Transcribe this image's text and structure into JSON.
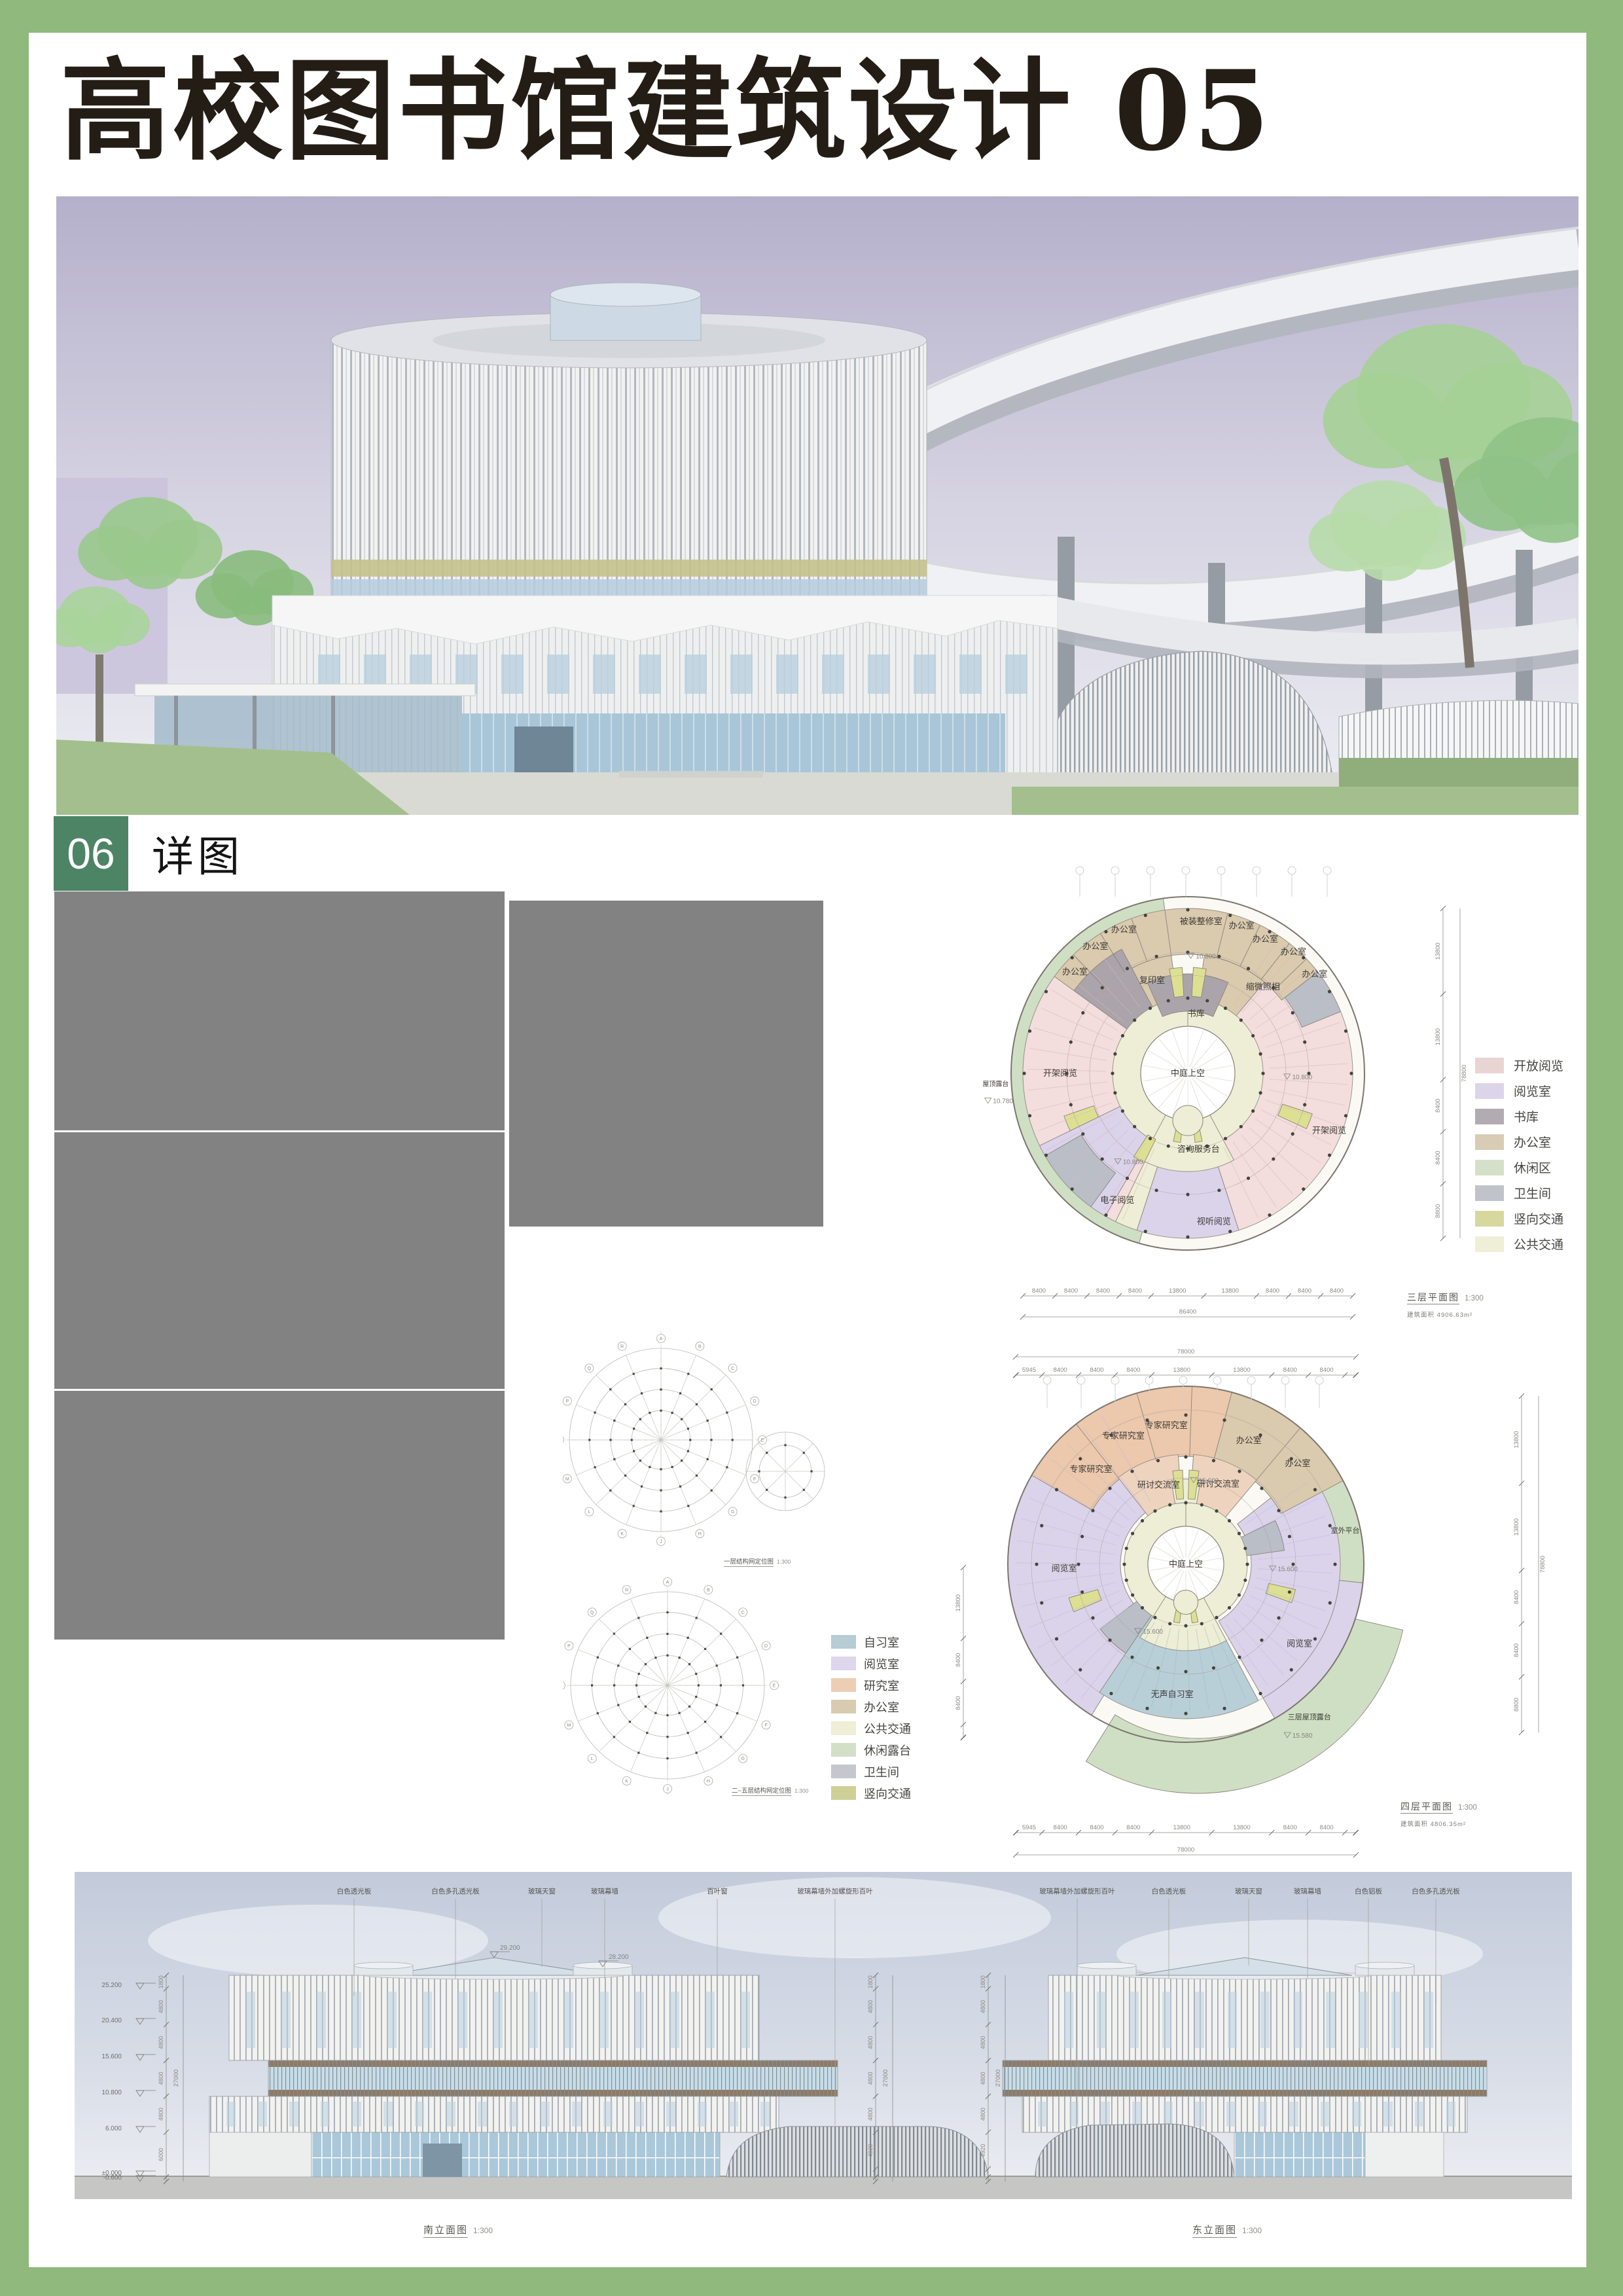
{
  "page": {
    "background_color": "#8fb97d",
    "title": "高校图书馆建筑设计 05",
    "section_number": "06",
    "section_title": "详图"
  },
  "palette": {
    "open": "#f3dddd",
    "reading": "#dbd3ea",
    "book": "#aba4aa",
    "office": "#dacaae",
    "terrace": "#cfdfc3",
    "wc": "#b9bec7",
    "stair": "#dde092",
    "core": "#edeed5",
    "study": "#b8cfd8",
    "expert": "#ecc8ac",
    "seminar": "#eed3bf",
    "atrium": "#ffffff",
    "accent_green": "#4d8465",
    "frame_green": "#8fb97d",
    "placeholder_gray": "#828282"
  },
  "legend_plan3": {
    "items": [
      {
        "label": "开放阅览",
        "color": "#e9d4d4"
      },
      {
        "label": "阅览室",
        "color": "#dcd5ea"
      },
      {
        "label": "书库",
        "color": "#b2acb2"
      },
      {
        "label": "办公室",
        "color": "#d8ccb4"
      },
      {
        "label": "休闲区",
        "color": "#d5e0c8"
      },
      {
        "label": "卫生间",
        "color": "#c0c3ca"
      },
      {
        "label": "竖向交通",
        "color": "#d6d89e"
      },
      {
        "label": "公共交通",
        "color": "#efeed7"
      }
    ]
  },
  "legend_plan4": {
    "items": [
      {
        "label": "自习室",
        "color": "#b7ccd5"
      },
      {
        "label": "阅览室",
        "color": "#ddd6ec"
      },
      {
        "label": "研究室",
        "color": "#edcdb4"
      },
      {
        "label": "办公室",
        "color": "#d8cbb1"
      },
      {
        "label": "公共交通",
        "color": "#efeed6"
      },
      {
        "label": "休闲露台",
        "color": "#d2e0c8"
      },
      {
        "label": "卫生间",
        "color": "#c4c7ce"
      },
      {
        "label": "竖向交通",
        "color": "#cfd096"
      }
    ]
  },
  "plan3": {
    "caption": "三层平面图",
    "scale": "1:300",
    "area_label": "建筑面积",
    "area_value": "4906.63m²",
    "sectors": [
      [
        197,
        332,
        108,
        252,
        "open"
      ],
      [
        28,
        162,
        108,
        252,
        "open"
      ],
      [
        306,
        52,
        182,
        252,
        "office"
      ],
      [
        210,
        244,
        112,
        252,
        "reading"
      ],
      [
        162,
        198,
        112,
        252,
        "reading"
      ],
      [
        198,
        206,
        112,
        252,
        "core"
      ],
      [
        0,
        360,
        72,
        115,
        "core"
      ],
      [
        352,
        8,
        115,
        148,
        "core"
      ],
      [
        152,
        208,
        72,
        150,
        "core"
      ],
      [
        306,
        332,
        115,
        215,
        "book"
      ],
      [
        332,
        352,
        115,
        182,
        "office"
      ],
      [
        8,
        40,
        115,
        182,
        "office"
      ],
      [
        336,
        24,
        95,
        152,
        "book"
      ],
      [
        216,
        240,
        188,
        252,
        "wc"
      ],
      [
        52,
        68,
        188,
        252,
        "wc"
      ],
      [
        350,
        357,
        118,
        162,
        "stair"
      ],
      [
        3,
        10,
        118,
        162,
        "stair"
      ],
      [
        244,
        251,
        152,
        200,
        "stair"
      ],
      [
        108,
        115,
        152,
        200,
        "stair"
      ],
      [
        168,
        174,
        76,
        106,
        "stair"
      ],
      [
        186,
        192,
        76,
        106,
        "stair"
      ],
      [
        206,
        213,
        112,
        152,
        "stair"
      ],
      [
        196,
        352,
        252,
        270,
        "terrace"
      ]
    ],
    "dividers": [
      [
        316,
        182,
        252
      ],
      [
        328,
        182,
        252
      ],
      [
        340,
        182,
        252
      ],
      [
        352,
        182,
        252
      ],
      [
        14,
        182,
        252
      ],
      [
        26,
        182,
        252
      ],
      [
        38,
        182,
        252
      ],
      [
        46,
        182,
        252
      ]
    ],
    "labels": [
      {
        "t": "办公室",
        "a": 312,
        "r": 232
      },
      {
        "t": "办公室",
        "a": 324,
        "r": 240
      },
      {
        "t": "办公室",
        "a": 336,
        "r": 240
      },
      {
        "t": "被装整修室",
        "a": 5,
        "r": 233
      },
      {
        "t": "办公室",
        "a": 20,
        "r": 240
      },
      {
        "t": "办公室",
        "a": 30,
        "r": 237
      },
      {
        "t": "办公室",
        "a": 41,
        "r": 246
      },
      {
        "t": "办公室",
        "a": 52,
        "r": 246
      },
      {
        "t": "复印室",
        "a": 339,
        "r": 152
      },
      {
        "t": "缩微照相",
        "a": 41,
        "r": 175
      },
      {
        "t": "书库",
        "a": 8,
        "r": 92
      },
      {
        "t": "中庭上空",
        "a": 0,
        "r": 0
      },
      {
        "t": "咨询服务台",
        "a": 172,
        "r": 117
      },
      {
        "t": "电子阅览",
        "a": 209,
        "r": 222
      },
      {
        "t": "视听阅览",
        "a": 170,
        "r": 230
      },
      {
        "t": "开架阅览",
        "a": 270,
        "r": 195
      },
      {
        "t": "开架阅览",
        "a": 112,
        "r": 233
      },
      {
        "t": "屋顶露台",
        "a": 267,
        "r": 294,
        "fs": 10
      },
      {
        "t": "10.800",
        "a": 7,
        "r": 177,
        "lvl": 1
      },
      {
        "t": "10.800",
        "a": 93,
        "r": 169,
        "lvl": 1
      },
      {
        "t": "10.800",
        "a": 213,
        "r": 165,
        "lvl": 1
      },
      {
        "t": "10.780",
        "a": 261,
        "r": 292,
        "lvl": 1
      }
    ],
    "dims_bottom": {
      "segments": [
        "8400",
        "8400",
        "8400",
        "8400",
        "13800",
        "13800",
        "8400",
        "8400",
        "8400"
      ],
      "total": "86400"
    },
    "dims_right": {
      "segments": [
        "13800",
        "13800",
        "8400",
        "8400",
        "8800"
      ],
      "total": "78800"
    }
  },
  "plan4": {
    "caption": "四层平面图",
    "scale": "1:300",
    "area_label": "建筑面积",
    "area_value": "4806.35m²",
    "sectors": [
      [
        103,
        212,
        238,
        322,
        "terrace",
        "o"
      ],
      [
        58,
        96,
        224,
        272,
        "terrace"
      ],
      [
        212,
        338,
        100,
        272,
        "reading"
      ],
      [
        52,
        150,
        100,
        236,
        "reading"
      ],
      [
        96,
        150,
        236,
        272,
        "reading"
      ],
      [
        300,
        15,
        165,
        272,
        "expert"
      ],
      [
        15,
        62,
        165,
        272,
        "office"
      ],
      [
        322,
        356,
        92,
        168,
        "seminar"
      ],
      [
        4,
        40,
        92,
        168,
        "seminar"
      ],
      [
        152,
        214,
        94,
        236,
        "study"
      ],
      [
        0,
        360,
        58,
        94,
        "core"
      ],
      [
        350,
        10,
        94,
        130,
        "core"
      ],
      [
        152,
        212,
        58,
        132,
        "core"
      ],
      [
        214,
        233,
        94,
        164,
        "wc"
      ],
      [
        64,
        82,
        94,
        152,
        "wc"
      ],
      [
        352,
        358,
        100,
        144,
        "stair"
      ],
      [
        2,
        8,
        100,
        144,
        "stair"
      ],
      [
        247,
        254,
        140,
        186,
        "stair"
      ],
      [
        103,
        110,
        130,
        172,
        "stair"
      ],
      [
        168,
        174,
        62,
        90,
        "stair"
      ],
      [
        186,
        192,
        62,
        90,
        "stair"
      ]
    ],
    "dividers": [
      [
        322,
        165,
        272
      ],
      [
        344,
        165,
        272
      ],
      [
        2,
        165,
        272
      ],
      [
        40,
        165,
        272
      ]
    ],
    "labels": [
      {
        "t": "专家研究室",
        "a": 315,
        "r": 205
      },
      {
        "t": "专家研究室",
        "a": 334,
        "r": 218
      },
      {
        "t": "专家研究室",
        "a": 352,
        "r": 214
      },
      {
        "t": "办公室",
        "a": 27,
        "r": 212
      },
      {
        "t": "办公室",
        "a": 48,
        "r": 230
      },
      {
        "t": "研讨交流室",
        "a": 341,
        "r": 128
      },
      {
        "t": "研讨交流室",
        "a": 22,
        "r": 132
      },
      {
        "t": "阅览室",
        "a": 268,
        "r": 186
      },
      {
        "t": "阅览室",
        "a": 125,
        "r": 212
      },
      {
        "t": "室外平台",
        "a": 78,
        "r": 249,
        "fs": 11
      },
      {
        "t": "无声自习室",
        "a": 186,
        "r": 200
      },
      {
        "t": "三层屋顶露台",
        "a": 141,
        "r": 300,
        "fs": 11
      },
      {
        "t": "中庭上空",
        "a": 0,
        "r": 0
      },
      {
        "t": "15.600",
        "a": 13,
        "r": 128,
        "lvl": 1
      },
      {
        "t": "15.600",
        "a": 94,
        "r": 150,
        "lvl": 1
      },
      {
        "t": "15.600",
        "a": 208,
        "r": 120,
        "lvl": 1
      },
      {
        "t": "15.580",
        "a": 147,
        "r": 316,
        "lvl": 1
      }
    ],
    "dims_top": {
      "segments": [
        "100",
        "5945",
        "8400",
        "8400",
        "8400",
        "13800",
        "13800",
        "8400",
        "8400",
        "2455",
        "100"
      ],
      "total": "78000"
    },
    "dims_bottom": {
      "segments": [
        "100",
        "5945",
        "8400",
        "8400",
        "8400",
        "13800",
        "13800",
        "8400",
        "8400",
        "2455",
        "100"
      ],
      "total": "78000"
    },
    "dims_left": {
      "segments": [
        "13800",
        "8400",
        "8400",
        "2455",
        "100"
      ],
      "total": ""
    },
    "dims_right": {
      "segments": [
        "13800",
        "13800",
        "8400",
        "8400",
        "8800"
      ],
      "total": "78800"
    }
  },
  "structure_diagrams": [
    {
      "caption": "一层结构网定位图",
      "scale": "1:300"
    },
    {
      "caption": "二~五层结构网定位图",
      "scale": "1:300"
    }
  ],
  "axis_letters": [
    "A",
    "B",
    "C",
    "D",
    "E",
    "F",
    "G",
    "H",
    "J",
    "K",
    "L",
    "M",
    "N",
    "P",
    "Q",
    "R"
  ],
  "elevations": {
    "south": {
      "caption": "南立面图",
      "scale": "1:300",
      "callouts": [
        "白色透光板",
        "白色多孔透光板",
        "玻璃天窗",
        "玻璃幕墙",
        "百叶窗",
        "玻璃幕墙外加螺旋形百叶"
      ],
      "levels": [
        "25.200",
        "20.400",
        "15.600",
        "10.800",
        "6.000",
        "±0.000",
        "-0.600"
      ],
      "dims_left": [
        "1800",
        "4800",
        "4800",
        "4800",
        "4800",
        "6000",
        "600"
      ],
      "dims_right": [
        "1800",
        "4800",
        "4800",
        "4800",
        "4800",
        "4920",
        "1080",
        "600"
      ],
      "total": "27000",
      "roof_levels": [
        "29.200",
        "28.200"
      ]
    },
    "east": {
      "caption": "东立面图",
      "scale": "1:300",
      "callouts": [
        "玻璃幕墙外加螺旋形百叶",
        "白色透光板",
        "玻璃天窗",
        "玻璃幕墙",
        "白色铝板",
        "白色多孔透光板"
      ],
      "levels": [
        "25.200",
        "20.400",
        "15.600",
        "10.800",
        "6.000",
        "±0.000",
        "-0.600"
      ],
      "dims": [
        "1800",
        "4800",
        "4800",
        "4800",
        "4800",
        "4920",
        "1080",
        "600"
      ],
      "total": "27000"
    }
  }
}
